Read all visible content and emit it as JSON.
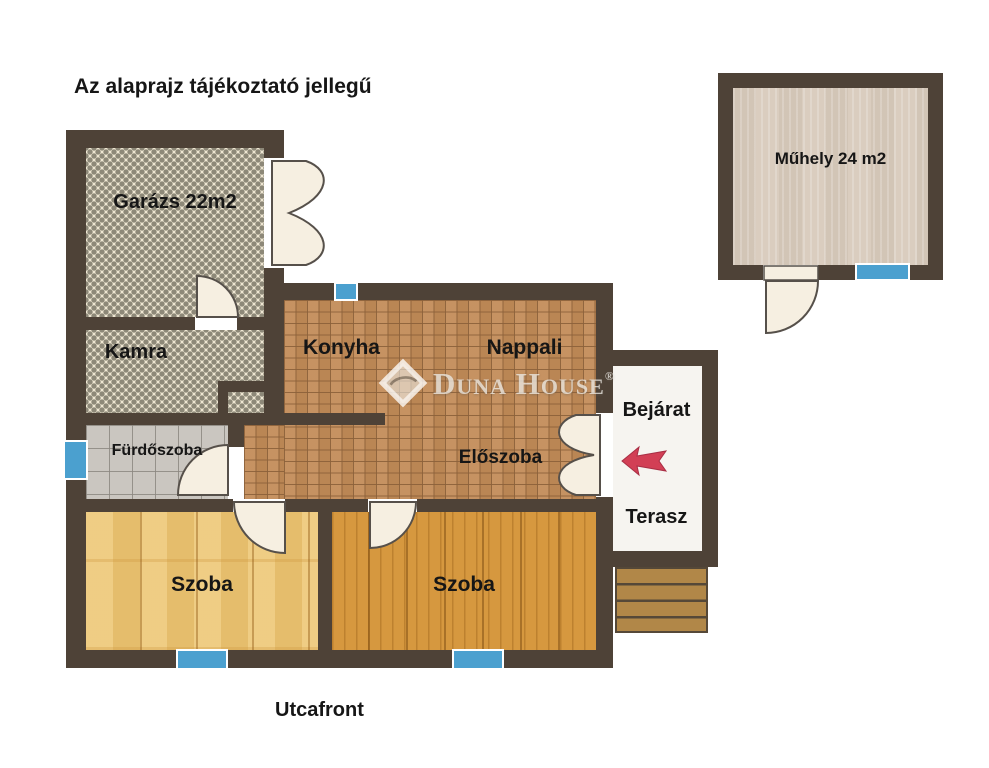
{
  "title": "Az alaprajz tájékoztató jellegű",
  "street_label": "Utcafront",
  "watermark": {
    "brand": "Duna House",
    "registered": "®"
  },
  "rooms": {
    "garage": {
      "label": "Garázs 22m2"
    },
    "pantry": {
      "label": "Kamra"
    },
    "kitchen": {
      "label": "Konyha"
    },
    "living_room": {
      "label": "Nappali"
    },
    "bathroom": {
      "label": "Fürdőszoba"
    },
    "hallway": {
      "label": "Előszoba"
    },
    "room_left": {
      "label": "Szoba"
    },
    "room_right": {
      "label": "Szoba"
    },
    "entrance": {
      "label": "Bejárat"
    },
    "terrace": {
      "label": "Terasz"
    },
    "workshop": {
      "label": "Műhely 24 m2"
    }
  },
  "colors": {
    "wall": "#4e4237",
    "window_blue": "#4ba0cf",
    "arrow_red": "#d23f55",
    "terracotta_tile": "#c28c59",
    "mosaic_dot": "#8d8878",
    "mosaic_bg": "#eee6d2",
    "bathroom_tile": "#cac6c0",
    "pine_wood": "#edc776",
    "orange_wood": "#d6983f",
    "workshop_floor": "#dacdbf",
    "steps_wood": "#b18748",
    "door_fill": "#f6efe1"
  }
}
